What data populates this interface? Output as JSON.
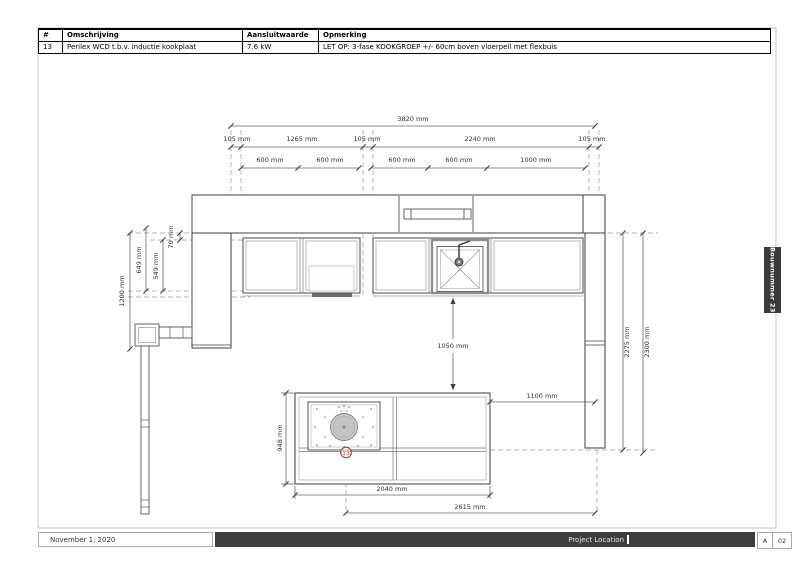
{
  "table": {
    "columns": [
      "#",
      "Omschrijving",
      "Aansluitwaarde",
      "Opmerking"
    ],
    "rows": [
      [
        "13",
        "Perilex WCD t.b.v. inductie kookplaat",
        "7.6 kW",
        "LET OP: 3-fase KOOKGROEP +/- 60cm boven vloerpeil met flexbuis"
      ]
    ]
  },
  "drawing": {
    "dims": {
      "total": "3820 mm",
      "top_row": [
        "105 mm",
        "1265 mm",
        "105 mm",
        "2240 mm",
        "105 mm"
      ],
      "unit_row": [
        "600 mm",
        "600 mm",
        "600 mm",
        "600 mm",
        "1000 mm"
      ],
      "left": {
        "d70": "70 mm",
        "d549": "549 mm",
        "d649": "649 mm",
        "d1200": "1200 mm"
      },
      "clearance": "1050 mm",
      "right": {
        "d2275": "2275 mm",
        "d2300": "2300 mm"
      },
      "island": {
        "depth": "948 mm",
        "gap": "1100 mm",
        "width": "2040 mm",
        "span": "2615 mm"
      }
    },
    "marker": {
      "label": "13",
      "color": "#a8423b"
    }
  },
  "side_tab": {
    "label": "Bouwnummer 23"
  },
  "footer": {
    "date": "November 1, 2020",
    "project_label": "Project Location",
    "revision": "A",
    "sheet_number": "02"
  }
}
